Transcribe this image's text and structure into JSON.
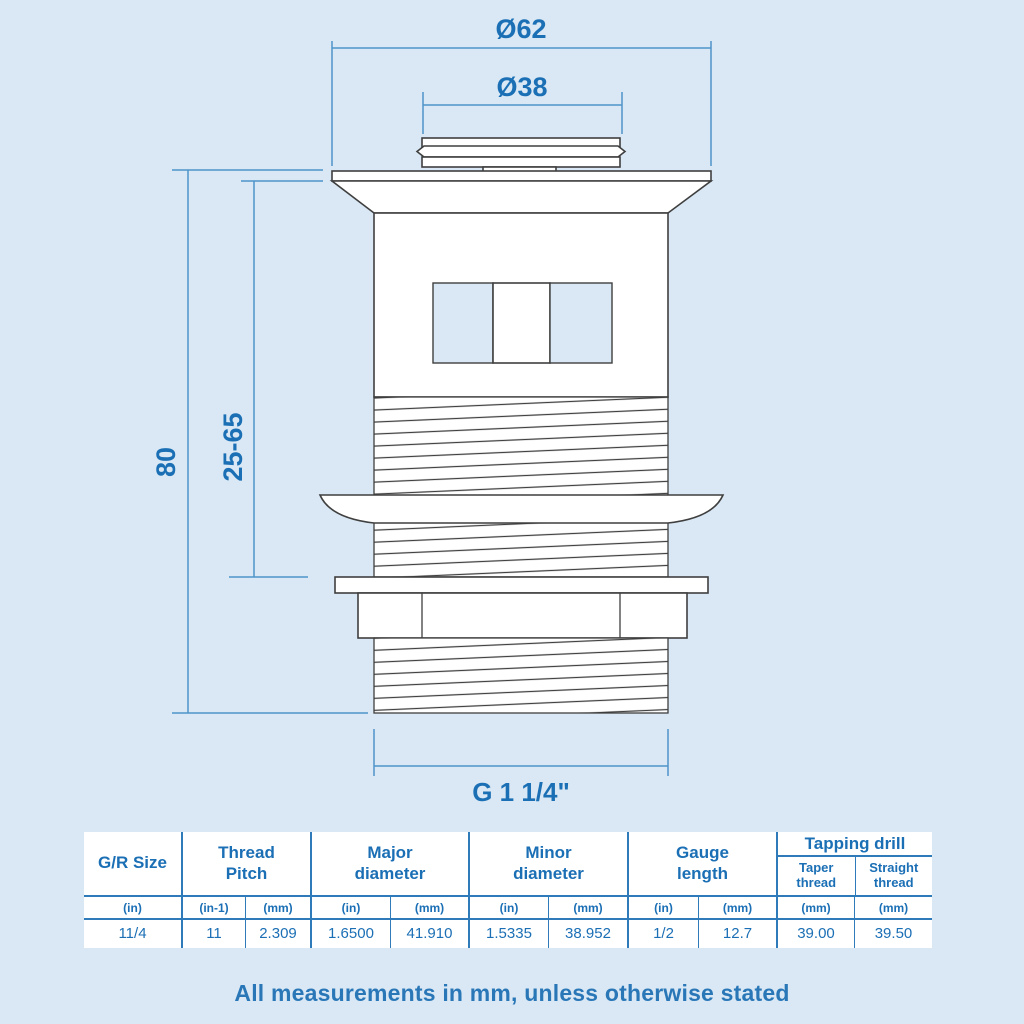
{
  "page": {
    "note": "All measurements in mm, unless otherwise stated"
  },
  "colors": {
    "background": "#d9e8f4",
    "accent_text": "#1b6fb5",
    "dimension_line": "#4e94c9",
    "drawing_outline": "#3f3f3f",
    "table_line": "#2f7ab8"
  },
  "diagram": {
    "outer_diameter_label": "Ø62",
    "plug_diameter_label": "Ø38",
    "overall_length_label": "80",
    "clamping_range_label": "25-65",
    "thread_size_label": "G 1 1/4\""
  },
  "spec_table": {
    "headers": {
      "gr_size": "G/R Size",
      "thread_pitch": "Thread Pitch",
      "major_diameter": "Major diameter",
      "minor_diameter": "Minor diameter",
      "gauge_length": "Gauge length",
      "tapping_drill": "Tapping drill",
      "taper_thread": "Taper thread",
      "straight_thread": "Straight thread"
    },
    "units": [
      "(in)",
      "(in-1)",
      "(mm)",
      "(in)",
      "(mm)",
      "(in)",
      "(mm)",
      "(in)",
      "(mm)",
      "(mm)",
      "(mm)"
    ],
    "values": [
      "11/4",
      "11",
      "2.309",
      "1.6500",
      "41.910",
      "1.5335",
      "38.952",
      "1/2",
      "12.7",
      "39.00",
      "39.50"
    ]
  }
}
